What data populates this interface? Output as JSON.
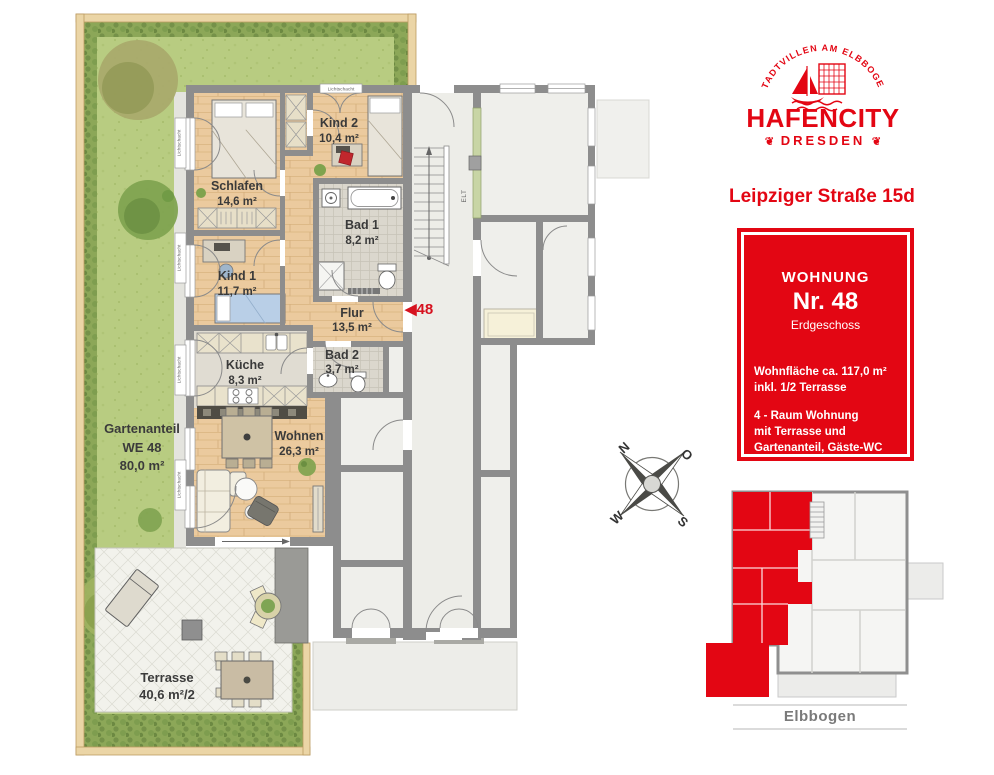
{
  "branding": {
    "arc_text": "STADTVILLEN AM ELBBOGEN",
    "name": "HAFENCITY",
    "city": "DRESDEN",
    "ornament": "❦",
    "address": "Leipziger Straße 15d"
  },
  "info_box": {
    "label": "WOHNUNG",
    "number": "Nr. 48",
    "floor": "Erdgeschoss",
    "area_lines": [
      "Wohnfläche ca. 117,0 m²",
      "inkl. 1/2 Terrasse"
    ],
    "type_lines": [
      "4 - Raum Wohnung",
      "mit Terrasse und",
      "Gartenanteil, Gäste-WC"
    ]
  },
  "floorplan": {
    "rooms": [
      {
        "name": "Schlafen",
        "area": "14,6 m²"
      },
      {
        "name": "Kind 2",
        "area": "10,4 m²"
      },
      {
        "name": "Kind 1",
        "area": "11,7 m²"
      },
      {
        "name": "Bad 1",
        "area": "8,2 m²"
      },
      {
        "name": "Flur",
        "area": "13,5 m²"
      },
      {
        "name": "Bad 2",
        "area": "3,7 m²"
      },
      {
        "name": "Küche",
        "area": "8,3 m²"
      },
      {
        "name": "Wohnen",
        "area": "26,3 m²"
      }
    ],
    "garden_label": {
      "line1": "Gartenanteil",
      "line2": "WE 48",
      "line3": "80,0 m²"
    },
    "terrace_label": {
      "name": "Terrasse",
      "area": "40,6 m²/2"
    },
    "unit_marker": "◀48",
    "lichtschacht": "Lichtschacht",
    "elt": "ELT"
  },
  "compass": {
    "north": "N",
    "east": "O",
    "south": "S",
    "west": "W"
  },
  "overview": {
    "district": "Elbbogen"
  },
  "colors": {
    "brand_red": "#E30613",
    "wall_gray": "#8D8D8D",
    "lawn_green": "#B8CC81",
    "hedge_green": "#8CA758",
    "wood": "#EBCA9E",
    "fence_tan": "#EBD5A6"
  }
}
